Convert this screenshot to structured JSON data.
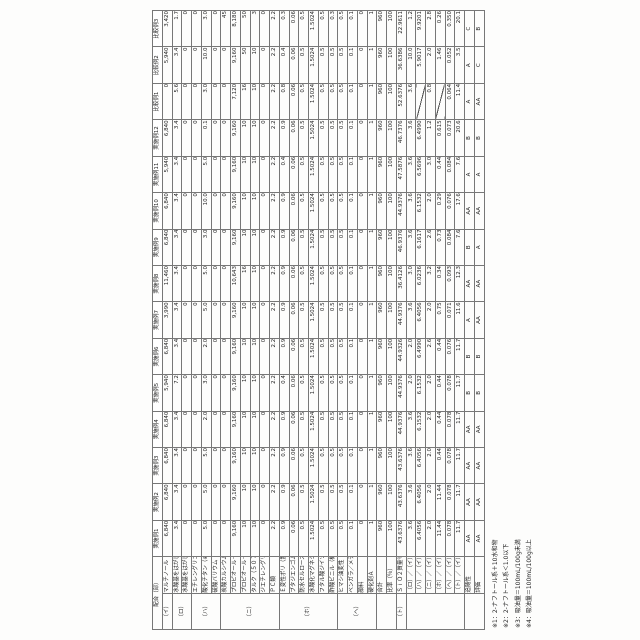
{
  "table": {
    "corner_label": "配合（部）",
    "columns": [
      "実施例1",
      "実施例2",
      "実施例3",
      "実施例4",
      "実施例5",
      "実施例6",
      "実施例7",
      "実施例8",
      "実施例9",
      "実施例10",
      "実施例11",
      "実施例12",
      "比較例1",
      "比較例2",
      "比較例3"
    ],
    "rows": [
      {
        "group": "（イ）",
        "gspan": 1,
        "label": "マルチノール",
        "values": [
          "6,840",
          "6,840",
          "6,840",
          "6,840",
          "5,940",
          "6,840",
          "3,990",
          "11,460",
          "6,840",
          "6,840",
          "5,940",
          "6,840",
          "0",
          "5,940",
          "3,420"
        ]
      },
      {
        "group": "（ロ）",
        "gspan": 2,
        "label": "水酸基をはがしたトルエン－２４ジイソシア（※1）",
        "values": [
          "3.4",
          "3.4",
          "3.4",
          "3.4",
          "7.2",
          "3.4",
          "3.4",
          "3.4",
          "3.4",
          "3.4",
          "3.4",
          "3.4",
          "5.6",
          "3.4",
          "1.7"
        ]
      },
      {
        "group": null,
        "label": "水酸基をはがしたもの（Ｑ－３７タノール）（※2）",
        "values": [
          "0",
          "0",
          "0",
          "0",
          "0",
          "0",
          "0",
          "0",
          "0",
          "0",
          "0",
          "0",
          "0",
          "0",
          "0"
        ]
      },
      {
        "group": "（ハ）",
        "gspan": 3,
        "label": "エチレングリコール",
        "values": [
          "0",
          "0",
          "0",
          "0",
          "0",
          "0",
          "0",
          "0",
          "0",
          "0",
          "0",
          "0",
          "0",
          "0",
          "0"
        ]
      },
      {
        "group": null,
        "label": "酸化チタン（※3）",
        "values": [
          "5.0",
          "5.0",
          "5.0",
          "2.0",
          "3.0",
          "2.0",
          "5.0",
          "5.0",
          "3.0",
          "10.0",
          "5.0",
          "0.1",
          "3.0",
          "10.0",
          "3.0"
        ]
      },
      {
        "group": null,
        "label": "硫酸バリウム（※4）",
        "values": [
          "0",
          "0",
          "0",
          "0",
          "0",
          "0",
          "0",
          "0",
          "0",
          "0",
          "0",
          "0",
          "0",
          "0",
          "0"
        ]
      },
      {
        "group": "（ニ）",
        "gspan": 6,
        "label": "炭酸カルシウム（うち－重質／軽質配合）",
        "values": [
          "0",
          "0",
          "0",
          "0",
          "0",
          "0",
          "0",
          "0",
          "0",
          "0",
          "0",
          "0",
          "0",
          "0",
          "45"
        ]
      },
      {
        "group": null,
        "label": "プロピオール－Ａ（５４）",
        "values": [
          "9,160",
          "9,160",
          "9,160",
          "9,160",
          "9,160",
          "9,160",
          "9,160",
          "10,643",
          "9,160",
          "9,160",
          "9,160",
          "9,160",
          "7,120",
          "9,160",
          "8,180"
        ]
      },
      {
        "group": null,
        "label": "プロピオール－Ｂ（５４５）",
        "values": [
          "10",
          "10",
          "10",
          "10",
          "10",
          "10",
          "10",
          "16",
          "10",
          "10",
          "10",
          "10",
          "16",
          "50",
          "50"
        ]
      },
      {
        "group": null,
        "label": "タルク（５０７）",
        "values": [
          "10",
          "10",
          "10",
          "10",
          "10",
          "10",
          "10",
          "10",
          "10",
          "10",
          "10",
          "10",
          "10",
          "10",
          "3"
        ]
      },
      {
        "group": null,
        "label": "ジエチレングリコール（５２）",
        "values": [
          "0",
          "0",
          "0",
          "0",
          "0",
          "0",
          "0",
          "0",
          "0",
          "0",
          "0",
          "0",
          "0",
          "0",
          "0"
        ]
      },
      {
        "group": null,
        "label": "ＰＣ類",
        "values": [
          "2.2",
          "2.2",
          "2.2",
          "2.2",
          "2.2",
          "2.2",
          "2.2",
          "2.2",
          "2.2",
          "2.2",
          "2.2",
          "2.2",
          "2.2",
          "2.2",
          "2.2"
        ]
      },
      {
        "group": "（ホ）",
        "gspan": 6,
        "label": "Ｅ変性ポリ（置換ナイロン）ゴム",
        "values": [
          "0.9",
          "0.9",
          "0.9",
          "0.9",
          "0.4",
          "0.9",
          "0.9",
          "0.9",
          "0.9",
          "0.9",
          "0.4",
          "0.9",
          "0.8",
          "0.4",
          "0.3"
        ]
      },
      {
        "group": null,
        "label": "ブタジエンゴム",
        "values": [
          "0.06",
          "0.06",
          "0.06",
          "0.06",
          "0.06",
          "0.06",
          "0.06",
          "0.06",
          "0.06",
          "0.06",
          "0.06",
          "0.06",
          "0.06",
          "0.06",
          "0.06"
        ]
      },
      {
        "group": null,
        "label": "防水セルロース",
        "values": [
          "0.5",
          "0.5",
          "0.5",
          "0.5",
          "0.5",
          "0.5",
          "0.5",
          "0.5",
          "0.5",
          "0.5",
          "0.5",
          "0.5",
          "0.5",
          "0.5",
          "0.5"
        ]
      },
      {
        "group": null,
        "label": "水酸化マグネシウム",
        "values": [
          "1.5024",
          "1.5024",
          "1.5024",
          "1.5024",
          "1.5024",
          "1.5024",
          "1.5024",
          "1.5024",
          "1.5024",
          "1.5024",
          "1.5024",
          "1.5024",
          "1.5024",
          "1.5024",
          "1.5024"
        ]
      },
      {
        "group": null,
        "label": "フタル酸ジイソノニル",
        "values": [
          "0.5",
          "0.5",
          "0.5",
          "0.5",
          "0.5",
          "0.5",
          "0.5",
          "0.5",
          "0.5",
          "0.5",
          "0.5",
          "0.5",
          "0.5",
          "0.5",
          "0.5"
        ]
      },
      {
        "group": null,
        "label": "酢酸ビニル（機能性モノマー）系",
        "values": [
          "0.5",
          "0.5",
          "0.5",
          "0.5",
          "0.5",
          "0.5",
          "0.5",
          "0.5",
          "0.5",
          "0.5",
          "0.5",
          "0.5",
          "0.5",
          "0.5",
          "0.3"
        ]
      },
      {
        "group": "（ヘ）",
        "gspan": 4,
        "label": "ヒマシ油変性（硬化ジエステル・テルペン系ゴム）",
        "values": [
          "0.5",
          "0.5",
          "0.5",
          "0.5",
          "0.5",
          "0.5",
          "0.5",
          "0.5",
          "0.5",
          "0.5",
          "0.5",
          "0.5",
          "0.5",
          "0.5",
          "0.5"
        ]
      },
      {
        "group": null,
        "label": "ベンガラ／メチロール",
        "values": [
          "0.1",
          "0.1",
          "0.1",
          "0.1",
          "0.1",
          "0.1",
          "0.1",
          "0.1",
          "0.1",
          "0.1",
          "0.1",
          "0.1",
          "0.1",
          "0.1",
          "0.1"
        ]
      },
      {
        "group": null,
        "label": "顔料",
        "values": [
          "0",
          "0",
          "0",
          "0",
          "0",
          "0",
          "0",
          "0",
          "0",
          "0",
          "0",
          "0",
          "0",
          "0",
          "0"
        ]
      },
      {
        "group": null,
        "label": "硬化剤Ａ",
        "values": [
          "1",
          "1",
          "1",
          "1",
          "1",
          "1",
          "1",
          "1",
          "1",
          "1",
          "1",
          "1",
          "1",
          "1",
          "1"
        ]
      },
      {
        "group": "",
        "gspan": 2,
        "label": "合計",
        "sep": true,
        "values": [
          "960",
          "960",
          "960",
          "960",
          "960",
          "960",
          "960",
          "960",
          "960",
          "960",
          "960",
          "960",
          "960",
          "960",
          "960"
        ]
      },
      {
        "group": null,
        "label": "比率（％）",
        "values": [
          "100",
          "100",
          "100",
          "100",
          "100",
          "100",
          "100",
          "100",
          "100",
          "100",
          "100",
          "100",
          "100",
          "100",
          "100"
        ]
      },
      {
        "group": "（ト）",
        "gspan": 1,
        "label": "ＳｉＯ２質量％",
        "values": [
          "43.6376",
          "43.6376",
          "43.6376",
          "44.9376",
          "44.9376",
          "44.9326",
          "44.9376",
          "36.4126",
          "46.9376",
          "44.9376",
          "47.5876",
          "46.7376",
          "52.6376",
          "36.6386",
          "22.9611"
        ]
      },
      {
        "group": "",
        "gspan": 6,
        "label": "（ロ）／（イ）",
        "sep": true,
        "values": [
          "3.6",
          "3.6",
          "3.6",
          "3.6",
          "2.0",
          "2.0",
          "3.6",
          "3.0",
          "3.6",
          "3.6",
          "3.6",
          "3.6",
          "3.6",
          "10.0",
          "1.2"
        ]
      },
      {
        "group": null,
        "label": "（ハ）／（イ）",
        "values": [
          "6.4056",
          "6.4056",
          "6.4056",
          "6.1532",
          "6.1532",
          "6.4990",
          "6.4056",
          "6.0236",
          "6.1617",
          "6.1532",
          "6.5696",
          "6.4990",
          "／",
          "5.9017",
          "9.9201"
        ]
      },
      {
        "group": null,
        "label": "（ニ）／（イ）",
        "values": [
          "2.0",
          "2.0",
          "2.0",
          "2.0",
          "2.0",
          "2.6",
          "2.0",
          "3.2",
          "2.6",
          "2.0",
          "3.0",
          "1.2",
          "0.8",
          "2.0",
          "2.8"
        ]
      },
      {
        "group": null,
        "label": "（ホ）／（イ）",
        "values": [
          "11.44",
          "11.44",
          "0.44",
          "0.44",
          "0.44",
          "0.44",
          "0.75",
          "0.34",
          "0.73",
          "0.29",
          "0.44",
          "0.615",
          "／",
          "1.46",
          "0.26"
        ]
      },
      {
        "group": null,
        "label": "（ヘ）／（イ）",
        "values": [
          "0.078",
          "0.078",
          "0.078",
          "0.078",
          "0.078",
          "0.076",
          "0.071",
          "0.093",
          "0.084",
          "0.076",
          "0.084",
          "0.073",
          "0.064",
          "0.052",
          "0.350"
        ]
      },
      {
        "group": null,
        "label": "（ト）／（イ）",
        "values": [
          "11.7",
          "11.7",
          "11.7",
          "11.7",
          "11.7",
          "11.7",
          "11.6",
          "12.3",
          "7.6",
          "17.6",
          "7.6",
          "20.6",
          "11.4",
          "3.5",
          "20.1"
        ]
      },
      {
        "group": "",
        "gspan": 2,
        "label": "追随性",
        "sep": true,
        "eval": true,
        "values": [
          "AA",
          "AA",
          "AA",
          "AA",
          "B",
          "B",
          "A",
          "AA",
          "B",
          "AA",
          "A",
          "B",
          "A",
          "A",
          "C"
        ]
      },
      {
        "group": null,
        "label": "評価",
        "eval": true,
        "values": [
          "AA",
          "AA",
          "AA",
          "AA",
          "B",
          "B",
          "AA",
          "AA",
          "A",
          "AA",
          "A",
          "B",
          "AA",
          "C",
          "B"
        ]
      }
    ],
    "footnotes": [
      "※1：2-ナフトール系＋10水和物",
      "※2：2-ナフトール系＜1.0以下",
      "※3：吸油量＝100mL/100g未満",
      "※4：吸油量＝100mL/100g以上"
    ]
  }
}
